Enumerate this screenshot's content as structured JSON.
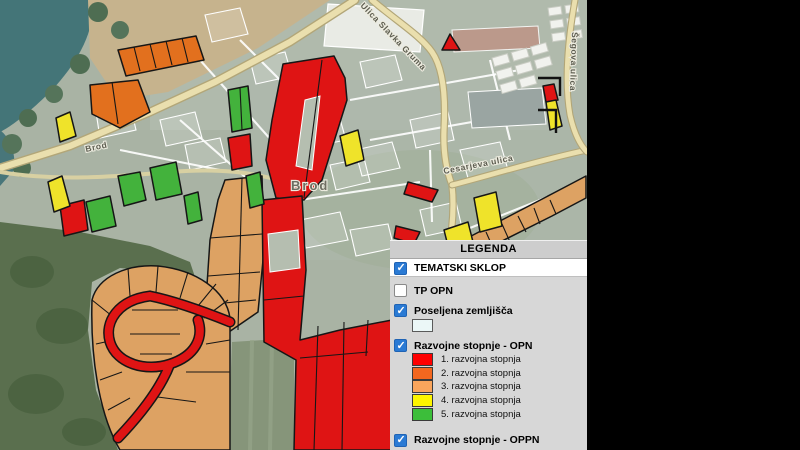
{
  "app": {
    "name": "GIS map viewer"
  },
  "map": {
    "labels": [
      {
        "text": "Brod"
      },
      {
        "text": "Brod"
      },
      {
        "text": "Ulica Slavka Gruma"
      },
      {
        "text": "Cesarjeva ulica"
      },
      {
        "text": "Šegova ulica"
      }
    ]
  },
  "legend": {
    "title": "LEGENDA",
    "layers": [
      {
        "label": "TEMATSKI SKLOP",
        "checked": true
      },
      {
        "label": "TP OPN",
        "checked": false
      },
      {
        "label": "Poseljena zemljišča",
        "checked": true,
        "swatch": "#ebf7f7"
      },
      {
        "label": "Razvojne stopnje - OPN",
        "checked": true
      },
      {
        "label": "Razvojne stopnje - OPPN",
        "checked": true
      }
    ],
    "opn_entries": [
      {
        "label": "1. razvojna stopnja",
        "color": "#fe0000"
      },
      {
        "label": "2. razvojna stopnja",
        "color": "#f3671f"
      },
      {
        "label": "3. razvojna stopnja",
        "color": "#f9a55c"
      },
      {
        "label": "4. razvojna stopnja",
        "color": "#fdf500"
      },
      {
        "label": "5. razvojna stopnja",
        "color": "#3cbe3a"
      }
    ]
  },
  "zone_colors": {
    "z1": "#df1414",
    "z2": "#e2701e",
    "z3": "#dda263",
    "z4": "#efe32a",
    "z5": "#43b23c"
  }
}
